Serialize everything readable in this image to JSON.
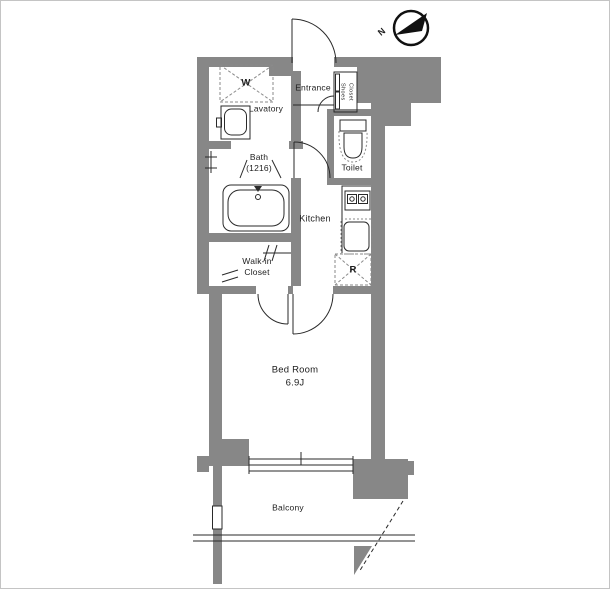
{
  "floorplan": {
    "compass": {
      "north": "N"
    },
    "rooms": {
      "entrance": "Entrance",
      "shoes_closet_line1": "Shoes",
      "shoes_closet_line2": "Closet",
      "lavatory": "Lavatory",
      "bath_line1": "Bath",
      "bath_line2": "(1216)",
      "toilet": "Toilet",
      "kitchen": "Kitchen",
      "walkin_line1": "Walk-in",
      "walkin_line2": "Closet",
      "bedroom_line1": "Bed Room",
      "bedroom_line2": "6.9J",
      "balcony": "Balcony"
    },
    "appliances": {
      "washer": "W",
      "refrigerator": "R"
    },
    "colors": {
      "wall": "#878787",
      "line": "#2a2a2a",
      "background": "#ffffff"
    }
  }
}
